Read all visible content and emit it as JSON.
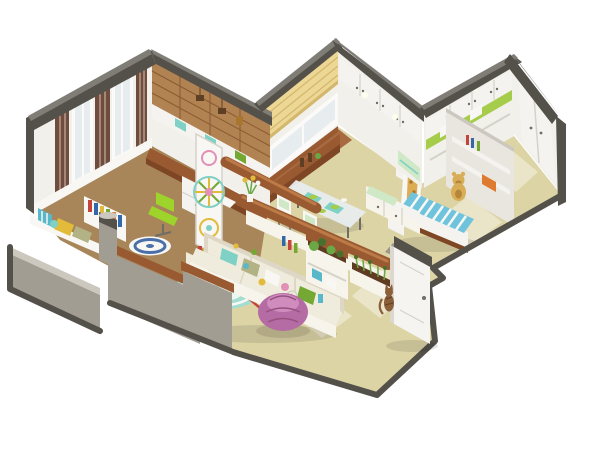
{
  "scene": {
    "description": "Isometric 3D cutaway dollhouse render of a small apartment floor plan on a white background",
    "rooms": [
      {
        "name": "study",
        "items": [
          "wood-accent-wall",
          "desk",
          "green-swivel-chair",
          "curtain-window-wall",
          "low-bookshelf",
          "round-blue-rug",
          "decorative-lattice-screen"
        ]
      },
      {
        "name": "kitchen-dining",
        "items": [
          "yellow-roman-shade-window",
          "wood-counter",
          "upper-cabinet-wall",
          "glass-dining-table",
          "white-chairs",
          "storage-bench",
          "tall-cabinet"
        ]
      },
      {
        "name": "living-room",
        "items": [
          "cream-sectional-sofa",
          "colorful-pillows",
          "wood-top-console",
          "teal-round-rug",
          "purple-bean-bag",
          "sofa-end-planter",
          "plant-shelf-unit"
        ]
      },
      {
        "name": "kids-bedroom",
        "items": [
          "striped-daybed",
          "teddy-bear",
          "wall-shelves",
          "orange-storage-box",
          "giraffe-decal",
          "green-accent-cabinets",
          "gray-floor-mat"
        ]
      },
      {
        "name": "entry-hall",
        "items": [
          "white-wardrobe",
          "front-door",
          "climbing-cat"
        ]
      }
    ],
    "cutaway": [
      "dark-gray-outer-walls",
      "half-height-front-walls",
      "wood-capped-ledges",
      "window-seat-cushions",
      "gray-pillar"
    ]
  },
  "palette": {
    "bg": "#ffffff",
    "wallDark": "#54514b",
    "capTop": "#807d77",
    "wallFace": "#f2f0ea",
    "wallFaceShade": "#e9e6df",
    "grayWall": "#a29d93",
    "grayWallLight": "#ccc8bf",
    "floorMain": "#ddd4a6",
    "floorKitchen": "#a86a40",
    "floorStudy": "#a8865a",
    "glare": "rgba(255,255,255,0.38)",
    "wood": "#9a5a31",
    "woodDark": "#7e4624",
    "woodLight": "#bb7a46",
    "woodWall": "#b28352",
    "woodWallLine": "#8a5a31",
    "plaid": "#6f4c3e",
    "plaidLine": "#d8c4b0",
    "curtain": "#f8f7f4",
    "frame": "#fbfaf8",
    "glassLight": "#e7edee",
    "shadeYellow": "#ecd795",
    "shadeYellowLine": "#d3b76e",
    "cabinet": "#f4f3ef",
    "cabinetSeam": "#d5d2c9",
    "handle": "#6f6d66",
    "greenAccent": "#a5cc4a",
    "mint": "#cfe8c6",
    "teal": "#7fd0c5",
    "chairGreen": "#9ed32b",
    "sofa": "#efebdd",
    "sofaShade": "#ded7c5",
    "sofaSkirt": "#f7f4ec",
    "pillowSage": "#b3b284",
    "rugTeal": "#a3ddd0",
    "rugTealLight": "#e9f6f1",
    "rugBlue": "#4b6fa8",
    "beanbag": "#b56ba3",
    "beanbagHi": "#cf8cbd",
    "beanbagLine": "#96527f",
    "bedStripe": "#6fc3dd",
    "teddy": "#d8ad57",
    "teddyDark": "#b4853a",
    "giraffe": "#dcab52",
    "giraffeSpot": "#a8762e",
    "plant": "#69a845",
    "plantDark": "#47702e",
    "soil": "#5f3b22",
    "door": "#f5f4f0",
    "doorEdge": "#dcd8d0",
    "catBrown": "#8a5f3a",
    "catDark": "#5f3f24",
    "bookRed": "#c2443a",
    "bookBlue": "#3468a8",
    "bookYellow": "#e3bb3a",
    "bookGreen": "#74a832",
    "bookOrange": "#df7b30",
    "toyTeal": "#58b8c9",
    "toyPink": "#e290b6",
    "matGray": "#8f8c84",
    "shadow": "rgba(0,0,0,0.10)",
    "glow": "rgba(255,255,235,0.85)"
  }
}
